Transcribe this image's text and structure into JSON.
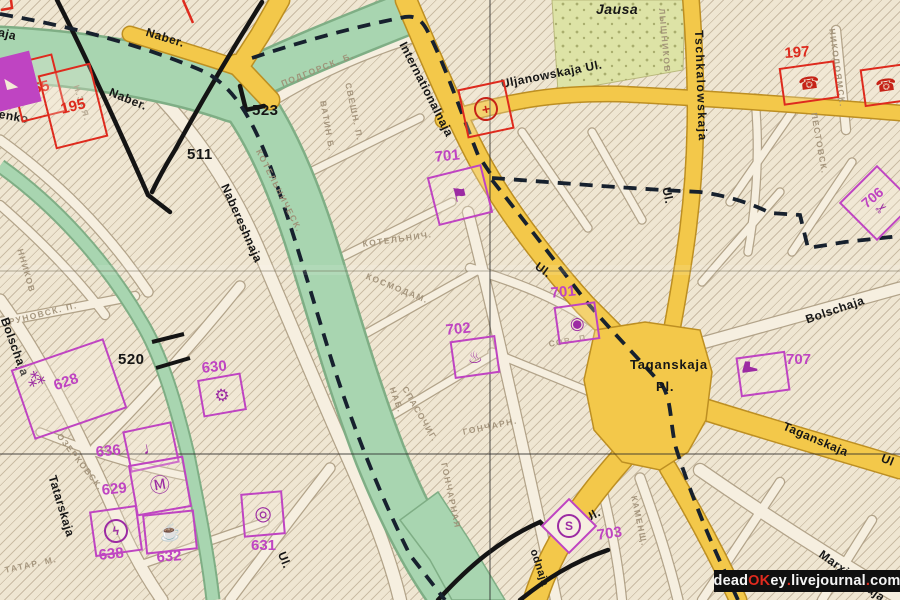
{
  "water": {
    "river_label": "Jausa"
  },
  "streets": {
    "aja_partial": "aja",
    "enko_partial": "enko",
    "naber_a": "Naber.",
    "naber_b": "Naber.",
    "nabereshnaja": "Nabereshnaja",
    "internationalnaja": "Internationalnaja",
    "uljanowskaja": "Uljanowskaja  Ul.",
    "tschkalowskaja": "Tschkalowskaja",
    "ul_tschkalowskaja": "Ul.",
    "ul_mid": "Ul.",
    "taganskaja_pl_1": "Taganskaja",
    "taganskaja_pl_2": "Pl.",
    "bolschaja_east": "Bolschaja",
    "taganskaja_street": "Taganskaja",
    "ul_right_edge": "Ul",
    "marxistskaja": "Marxistskaja",
    "bolschaja_west": "Bolschaja",
    "tatarskaja": "Tatarskaja",
    "ul_bottom_left": "Ul.",
    "ul_metro": "Ul.",
    "narodnaja_partial": "odnaja"
  },
  "route_numbers": {
    "n511": "511",
    "n520": "520",
    "n523": "523"
  },
  "pois": {
    "p755": {
      "num": "755"
    },
    "p195": {
      "num": "195"
    },
    "p197": {
      "num": "197",
      "icon": "telephone",
      "glyph": "☎"
    },
    "red_right": {
      "icon": "telephone",
      "glyph": "☎"
    },
    "medical": {
      "icon": "red-cross",
      "glyph": "+"
    },
    "tl_partial": {
      "icon": "triangle",
      "glyph": "◣"
    },
    "p701a": {
      "num": "701",
      "icon": "flag",
      "glyph": "⚑"
    },
    "p701b": {
      "num": "701",
      "icon": "camera",
      "glyph": "◉"
    },
    "p702": {
      "num": "702",
      "icon": "samovar",
      "glyph": "♨"
    },
    "p703": {
      "num": "703",
      "icon": "metro-station",
      "glyph": "S"
    },
    "p706": {
      "num": "706",
      "icon": "scissors",
      "glyph": "✂"
    },
    "p707": {
      "num": "707",
      "icon": "boot"
    },
    "p628": {
      "num": "628",
      "icon": "grapes",
      "glyph": "⁂"
    },
    "p629": {
      "num": "629",
      "icon": "circled-m",
      "glyph": "Ⓜ"
    },
    "p630": {
      "num": "630",
      "icon": "gear-flower",
      "glyph": "⚙"
    },
    "p631": {
      "num": "631",
      "icon": "dial",
      "glyph": "◎"
    },
    "p632": {
      "num": "632",
      "icon": "kettle",
      "glyph": "☕"
    },
    "p636": {
      "num": "636",
      "icon": "stemmed-dot",
      "glyph": "♩"
    },
    "p638": {
      "num": "638",
      "icon": "lightning",
      "glyph": "ϟ"
    }
  },
  "background_names": {
    "c1": "ПОДГОРСК. Б.",
    "c2": "СВЕШН. П.",
    "c3": "ВАТИН Б.",
    "c4a": "КОТЕЛЬНИЧЕСК.",
    "c4b": "НАБ.",
    "c5": "КОТЕЛЬНИЧ.",
    "c6": "КОСМОДАМ.",
    "c7": "ГОНЧАРНАЯ",
    "c8": "ГОНЧАРН.",
    "c9": "СПАСОЧИГ.",
    "c10": "КАМЕНЩ.",
    "c11": "НИКОЛОЯМСК.",
    "c12": "РУНОВСК. П.",
    "c13": "ОЗЕРКОВСК.",
    "c14": "ТАТАР. М.",
    "c15": "ННИКОВ",
    "c16": "ПЕСТОВСК.",
    "c17": "ЛЫШНИКОВ",
    "c18": "СОВ. П.",
    "c19": "Н.ЗАЯ."
  },
  "watermark": {
    "p1": "dead",
    "p2": "OK",
    "p3": "ey",
    "d1": ".",
    "p4": "livejournal",
    "d2": ".",
    "p5": "com"
  }
}
